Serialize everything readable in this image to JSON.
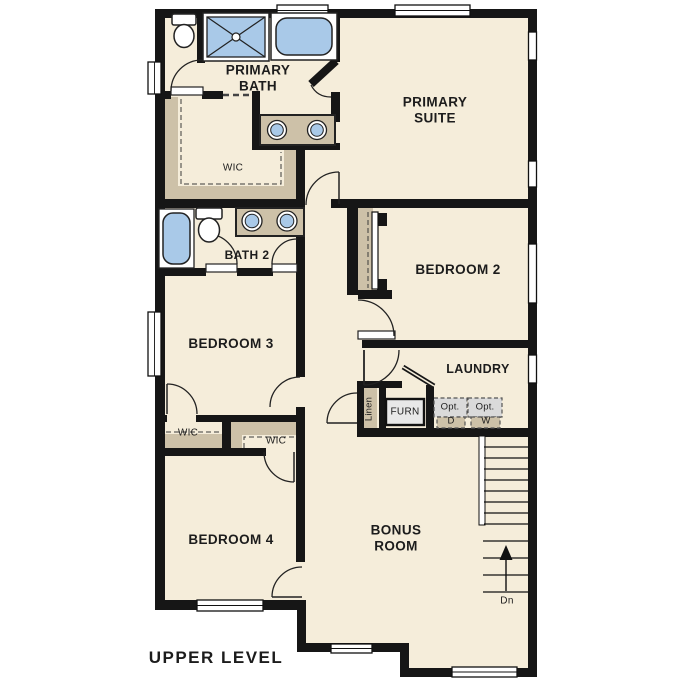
{
  "page": {
    "title": "UPPER LEVEL"
  },
  "colors": {
    "background": "#ffffff",
    "floor": "#f5edda",
    "wall": "#161616",
    "cabinet_tan": "#cdc1a8",
    "fixture_blue": "#a9c9e8",
    "optional_gray": "#dadada",
    "furnace_gray": "#e8e8e8"
  },
  "rooms": {
    "primary_bath": {
      "label": "PRIMARY\nBATH"
    },
    "primary_suite": {
      "label": "PRIMARY\nSUITE"
    },
    "primary_wic": {
      "label": "WIC"
    },
    "bath2": {
      "label": "BATH 2"
    },
    "bedroom2": {
      "label": "BEDROOM 2"
    },
    "bedroom3": {
      "label": "BEDROOM 3"
    },
    "laundry": {
      "label": "LAUNDRY"
    },
    "bedroom3_wic": {
      "label": "WIC"
    },
    "bedroom4_wic": {
      "label": "WIC"
    },
    "bedroom4": {
      "label": "BEDROOM 4"
    },
    "bonus_room": {
      "label": "BONUS\nROOM"
    }
  },
  "features": {
    "linen_closet": {
      "label": "Linen"
    },
    "furnace": {
      "label": "FURN"
    },
    "optional_dryer": {
      "line1": "Opt.",
      "line2": "D"
    },
    "optional_washer": {
      "line1": "Opt.",
      "line2": "W"
    },
    "stairs_direction": {
      "label": "Dn"
    }
  },
  "footer": {
    "level_label": "UPPER LEVEL"
  }
}
